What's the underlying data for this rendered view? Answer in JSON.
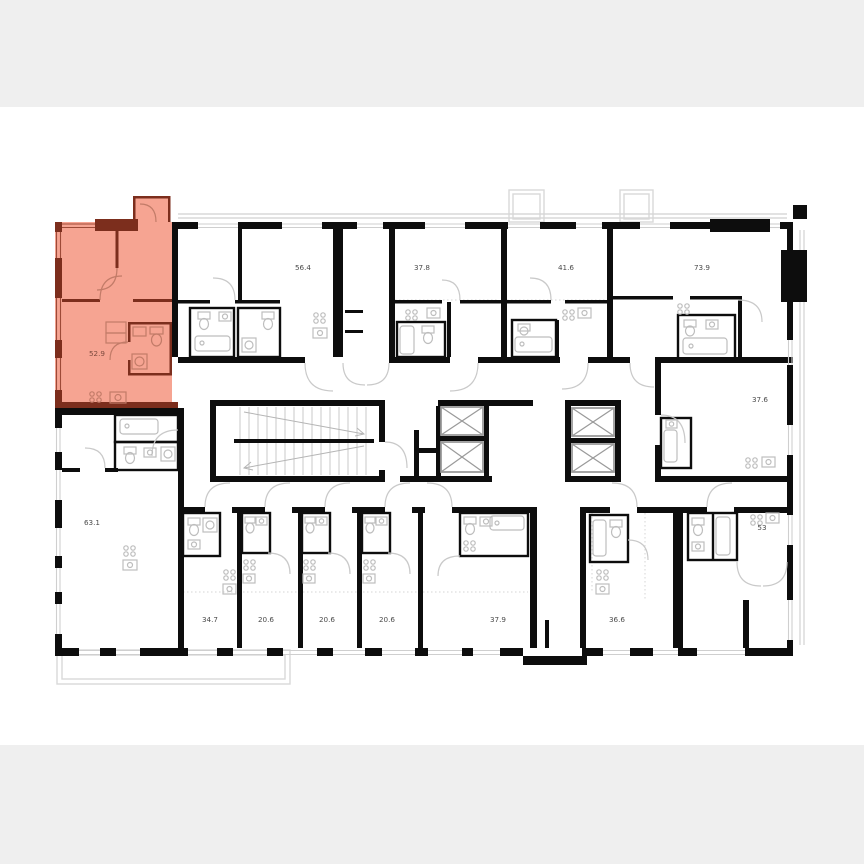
{
  "page": {
    "background": "#efefef",
    "canvas_background": "#ffffff"
  },
  "plan": {
    "wall_color": "#0d0d0d",
    "fixture_color": "#bdbdbd",
    "outline_color": "#d8d8d8",
    "label_color": "#4a4a4a",
    "highlight": {
      "fill": "#f6a492",
      "wall": "#7c2e1d",
      "fixture": "#c27b68"
    },
    "units": [
      {
        "area": "52.9",
        "highlighted": true
      },
      {
        "area": "56.4",
        "highlighted": false
      },
      {
        "area": "37.8",
        "highlighted": false
      },
      {
        "area": "41.6",
        "highlighted": false
      },
      {
        "area": "73.9",
        "highlighted": false
      },
      {
        "area": "37.6",
        "highlighted": false
      },
      {
        "area": "63.1",
        "highlighted": false
      },
      {
        "area": "34.7",
        "highlighted": false
      },
      {
        "area": "20.6",
        "highlighted": false
      },
      {
        "area": "20.6",
        "highlighted": false
      },
      {
        "area": "20.6",
        "highlighted": false
      },
      {
        "area": "37.9",
        "highlighted": false
      },
      {
        "area": "36.6",
        "highlighted": false
      },
      {
        "area": "53",
        "highlighted": false
      }
    ]
  }
}
